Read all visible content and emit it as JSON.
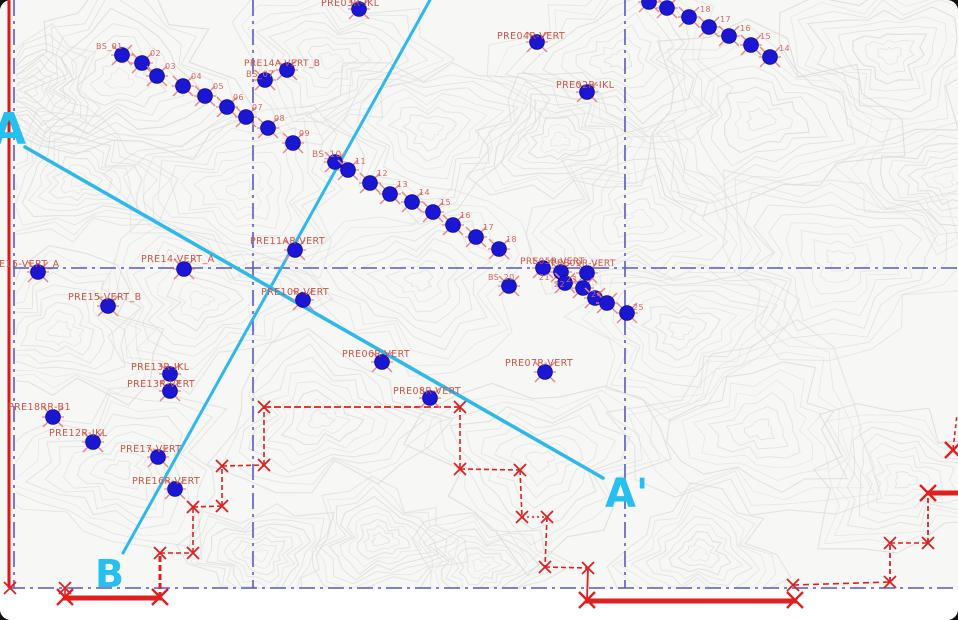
{
  "map": {
    "width": 958,
    "height": 620,
    "background": "#f7f7f6",
    "contour_color": "#dcdcdb",
    "content_bottom": 589
  },
  "colors": {
    "point_blue": "#1a16d2",
    "point_edge": "#0b0b99",
    "point_tick_red": "#ec8585",
    "label_red": "#c85648",
    "label_red_small": "#cf6a5e",
    "boundary_red": "#e02020",
    "frame_red": "#e01515",
    "grid_purple": "#5a58bf",
    "section_cyan": "#2fb9e8",
    "section_label_cyan": "#25c0f0"
  },
  "frame": {
    "left_red_line": {
      "x": 9,
      "y1": 0,
      "y2": 588
    }
  },
  "grid": {
    "vertical": [
      {
        "x": 14,
        "y1": 0,
        "y2": 588
      },
      {
        "x": 253,
        "y1": 0,
        "y2": 588
      },
      {
        "x": 625,
        "y1": 0,
        "y2": 588
      }
    ],
    "horizontal": [
      {
        "y": 268,
        "x1": 13,
        "x2": 958
      },
      {
        "y": 588,
        "x1": 9,
        "x2": 958
      }
    ]
  },
  "sections": {
    "lines": [
      {
        "name": "A-A'",
        "x1": 25,
        "y1": 147,
        "x2": 603,
        "y2": 478,
        "width": 3.6
      },
      {
        "name": "B",
        "x1": 430,
        "y1": 0,
        "x2": 123,
        "y2": 553,
        "width": 3.0
      }
    ],
    "labels": [
      {
        "text": "A",
        "x": -8,
        "y": 144,
        "fs": 44
      },
      {
        "text": "A'",
        "x": 605,
        "y": 507,
        "fs": 40
      },
      {
        "text": "B",
        "x": 95,
        "y": 587,
        "fs": 38
      }
    ]
  },
  "boundary": {
    "segments": [
      {
        "x1": 65,
        "y1": 589,
        "x2": 65,
        "y2": 597,
        "w": 1.6,
        "dash": ""
      },
      {
        "x1": 63,
        "y1": 598,
        "x2": 162,
        "y2": 598,
        "w": 5,
        "dash": ""
      },
      {
        "x1": 160,
        "y1": 598,
        "x2": 160,
        "y2": 554,
        "w": 3,
        "dash": "6 3"
      },
      {
        "x1": 160,
        "y1": 553,
        "x2": 193,
        "y2": 553,
        "w": 1.6,
        "dash": "5 3"
      },
      {
        "x1": 193,
        "y1": 553,
        "x2": 193,
        "y2": 507,
        "w": 1.6,
        "dash": "5 3"
      },
      {
        "x1": 193,
        "y1": 507,
        "x2": 222,
        "y2": 506,
        "w": 1.6,
        "dash": "5 3"
      },
      {
        "x1": 222,
        "y1": 506,
        "x2": 222,
        "y2": 466,
        "w": 1.6,
        "dash": "5 3"
      },
      {
        "x1": 222,
        "y1": 466,
        "x2": 264,
        "y2": 465,
        "w": 1.6,
        "dash": "5 3"
      },
      {
        "x1": 264,
        "y1": 465,
        "x2": 264,
        "y2": 407,
        "w": 1.6,
        "dash": "5 3"
      },
      {
        "x1": 264,
        "y1": 407,
        "x2": 460,
        "y2": 407,
        "w": 1.7,
        "dash": "7 3"
      },
      {
        "x1": 460,
        "y1": 407,
        "x2": 460,
        "y2": 469,
        "w": 1.6,
        "dash": "5 3"
      },
      {
        "x1": 460,
        "y1": 469,
        "x2": 520,
        "y2": 470,
        "w": 1.6,
        "dash": "5 3"
      },
      {
        "x1": 520,
        "y1": 470,
        "x2": 522,
        "y2": 517,
        "w": 1.6,
        "dash": "5 3"
      },
      {
        "x1": 522,
        "y1": 517,
        "x2": 547,
        "y2": 517,
        "w": 1.6,
        "dash": "2 3"
      },
      {
        "x1": 547,
        "y1": 517,
        "x2": 545,
        "y2": 567,
        "w": 1.6,
        "dash": "5 3"
      },
      {
        "x1": 545,
        "y1": 567,
        "x2": 588,
        "y2": 568,
        "w": 1.6,
        "dash": "5 3"
      },
      {
        "x1": 588,
        "y1": 568,
        "x2": 587,
        "y2": 600,
        "w": 1.8,
        "dash": ""
      },
      {
        "x1": 585,
        "y1": 601,
        "x2": 797,
        "y2": 601,
        "w": 5,
        "dash": ""
      },
      {
        "x1": 793,
        "y1": 585,
        "x2": 890,
        "y2": 582,
        "w": 1.6,
        "dash": "6 4"
      },
      {
        "x1": 890,
        "y1": 582,
        "x2": 890,
        "y2": 543,
        "w": 1.8,
        "dash": "5 3"
      },
      {
        "x1": 890,
        "y1": 543,
        "x2": 928,
        "y2": 543,
        "w": 1.6,
        "dash": "5 3"
      },
      {
        "x1": 928,
        "y1": 543,
        "x2": 928,
        "y2": 493,
        "w": 1.8,
        "dash": "5 3"
      },
      {
        "x1": 926,
        "y1": 493,
        "x2": 958,
        "y2": 493,
        "w": 5,
        "dash": ""
      },
      {
        "x1": 953,
        "y1": 449,
        "x2": 957,
        "y2": 415,
        "w": 1.6,
        "dash": "4 3"
      }
    ],
    "x_marks": [
      {
        "x": 10,
        "y": 588,
        "big": false
      },
      {
        "x": 65,
        "y": 588,
        "big": false
      },
      {
        "x": 65,
        "y": 597,
        "big": true
      },
      {
        "x": 160,
        "y": 597,
        "big": true
      },
      {
        "x": 160,
        "y": 553,
        "big": false
      },
      {
        "x": 193,
        "y": 553,
        "big": false
      },
      {
        "x": 193,
        "y": 507,
        "big": false
      },
      {
        "x": 222,
        "y": 506,
        "big": false
      },
      {
        "x": 222,
        "y": 466,
        "big": false
      },
      {
        "x": 264,
        "y": 465,
        "big": false
      },
      {
        "x": 264,
        "y": 407,
        "big": false
      },
      {
        "x": 460,
        "y": 407,
        "big": false
      },
      {
        "x": 460,
        "y": 469,
        "big": false
      },
      {
        "x": 520,
        "y": 470,
        "big": false
      },
      {
        "x": 522,
        "y": 517,
        "big": false
      },
      {
        "x": 547,
        "y": 517,
        "big": false
      },
      {
        "x": 545,
        "y": 567,
        "big": false
      },
      {
        "x": 588,
        "y": 568,
        "big": false
      },
      {
        "x": 587,
        "y": 600,
        "big": true
      },
      {
        "x": 795,
        "y": 600,
        "big": true
      },
      {
        "x": 793,
        "y": 585,
        "big": false
      },
      {
        "x": 890,
        "y": 582,
        "big": false
      },
      {
        "x": 890,
        "y": 543,
        "big": false
      },
      {
        "x": 928,
        "y": 543,
        "big": false
      },
      {
        "x": 928,
        "y": 493,
        "big": true
      },
      {
        "x": 953,
        "y": 450,
        "big": true
      }
    ]
  },
  "survey_points": {
    "points": [
      {
        "x": 122,
        "y": 55,
        "label": "BS_01",
        "lx": 96,
        "ly": 49,
        "fs": 8
      },
      {
        "x": 142,
        "y": 63,
        "label": "02",
        "lx": 150,
        "ly": 56,
        "fs": 8
      },
      {
        "x": 157,
        "y": 76,
        "label": "03",
        "lx": 165,
        "ly": 69,
        "fs": 8
      },
      {
        "x": 183,
        "y": 86,
        "label": "04",
        "lx": 191,
        "ly": 79,
        "fs": 8
      },
      {
        "x": 205,
        "y": 96,
        "label": "05",
        "lx": 213,
        "ly": 89,
        "fs": 8
      },
      {
        "x": 227,
        "y": 107,
        "label": "06",
        "lx": 233,
        "ly": 100,
        "fs": 8
      },
      {
        "x": 246,
        "y": 117,
        "label": "07",
        "lx": 252,
        "ly": 110,
        "fs": 8
      },
      {
        "x": 268,
        "y": 128,
        "label": "08",
        "lx": 274,
        "ly": 121,
        "fs": 8
      },
      {
        "x": 293,
        "y": 143,
        "label": "09",
        "lx": 299,
        "ly": 136,
        "fs": 8
      },
      {
        "x": 265,
        "y": 80,
        "label": "",
        "lx": 0,
        "ly": 0,
        "fs": 8
      },
      {
        "x": 287,
        "y": 70,
        "label": "",
        "lx": 0,
        "ly": 0,
        "fs": 8
      },
      {
        "x": 335,
        "y": 162,
        "label": "BS_10",
        "lx": 312,
        "ly": 157,
        "fs": 9
      },
      {
        "x": 348,
        "y": 170,
        "label": "11",
        "lx": 355,
        "ly": 164,
        "fs": 8
      },
      {
        "x": 370,
        "y": 183,
        "label": "12",
        "lx": 377,
        "ly": 176,
        "fs": 8
      },
      {
        "x": 390,
        "y": 194,
        "label": "13",
        "lx": 397,
        "ly": 187,
        "fs": 8
      },
      {
        "x": 412,
        "y": 202,
        "label": "14",
        "lx": 419,
        "ly": 195,
        "fs": 8
      },
      {
        "x": 433,
        "y": 212,
        "label": "15",
        "lx": 440,
        "ly": 205,
        "fs": 8
      },
      {
        "x": 453,
        "y": 225,
        "label": "16",
        "lx": 460,
        "ly": 218,
        "fs": 8
      },
      {
        "x": 476,
        "y": 237,
        "label": "17",
        "lx": 483,
        "ly": 230,
        "fs": 8
      },
      {
        "x": 499,
        "y": 249,
        "label": "18",
        "lx": 506,
        "ly": 242,
        "fs": 8
      },
      {
        "x": 543,
        "y": 268,
        "label": "",
        "lx": 0,
        "ly": 0,
        "fs": 8
      },
      {
        "x": 561,
        "y": 272,
        "label": "",
        "lx": 0,
        "ly": 0,
        "fs": 8
      },
      {
        "x": 587,
        "y": 273,
        "label": "",
        "lx": 0,
        "ly": 0,
        "fs": 8
      },
      {
        "x": 565,
        "y": 283,
        "label": "",
        "lx": 0,
        "ly": 0,
        "fs": 8
      },
      {
        "x": 583,
        "y": 288,
        "label": "",
        "lx": 0,
        "ly": 0,
        "fs": 8
      },
      {
        "x": 509,
        "y": 286,
        "label": "BS_20",
        "lx": 488,
        "ly": 280,
        "fs": 8
      },
      {
        "x": 595,
        "y": 298,
        "label": "",
        "lx": 0,
        "ly": 0,
        "fs": 8
      },
      {
        "x": 607,
        "y": 303,
        "label": "",
        "lx": 0,
        "ly": 0,
        "fs": 8
      },
      {
        "x": 627,
        "y": 313,
        "label": "",
        "lx": 0,
        "ly": 0,
        "fs": 8
      },
      {
        "x": 649,
        "y": 2,
        "label": "",
        "lx": 0,
        "ly": 0,
        "fs": 8
      },
      {
        "x": 667,
        "y": 8,
        "label": "",
        "lx": 0,
        "ly": 0,
        "fs": 8
      },
      {
        "x": 689,
        "y": 17,
        "label": "18",
        "lx": 700,
        "ly": 12,
        "fs": 8
      },
      {
        "x": 709,
        "y": 27,
        "label": "17",
        "lx": 720,
        "ly": 22,
        "fs": 8
      },
      {
        "x": 729,
        "y": 36,
        "label": "16",
        "lx": 740,
        "ly": 31,
        "fs": 8
      },
      {
        "x": 751,
        "y": 45,
        "label": "15",
        "lx": 760,
        "ly": 39,
        "fs": 8
      },
      {
        "x": 770,
        "y": 57,
        "label": "14",
        "lx": 779,
        "ly": 51,
        "fs": 8
      },
      {
        "x": 359,
        "y": 9,
        "label": "PRE03R-IKL",
        "lx": 321,
        "ly": 6,
        "fs": 9.5
      },
      {
        "x": 537,
        "y": 42,
        "label": "PRE04R-VERT",
        "lx": 497,
        "ly": 39,
        "fs": 9.5
      },
      {
        "x": 587,
        "y": 92,
        "label": "PRE02R-IKL",
        "lx": 556,
        "ly": 88,
        "fs": 9.5
      },
      {
        "x": 38,
        "y": 272,
        "label": "PRE15-VERT_A",
        "lx": -14,
        "ly": 267,
        "fs": 9.5
      },
      {
        "x": 184,
        "y": 269,
        "label": "PRE14-VERT_A",
        "lx": 141,
        "ly": 262,
        "fs": 9.5
      },
      {
        "x": 108,
        "y": 306,
        "label": "PRE15-VERT_B",
        "lx": 68,
        "ly": 300,
        "fs": 9.5
      },
      {
        "x": 295,
        "y": 250,
        "label": "PRE11AR-VERT",
        "lx": 250,
        "ly": 244,
        "fs": 9.5
      },
      {
        "x": 303,
        "y": 300,
        "label": "PRE10R-VERT",
        "lx": 261,
        "ly": 295,
        "fs": 9.5
      },
      {
        "x": 170,
        "y": 374,
        "label": "PRE13R-IKL",
        "lx": 131,
        "ly": 370,
        "fs": 9.5
      },
      {
        "x": 170,
        "y": 391,
        "label": "PRE13R-VERT",
        "lx": 127,
        "ly": 387,
        "fs": 9.5
      },
      {
        "x": 53,
        "y": 417,
        "label": "PRE18RR-B1",
        "lx": 8,
        "ly": 410,
        "fs": 9.5
      },
      {
        "x": 93,
        "y": 442,
        "label": "PRE12R-IKL",
        "lx": 49,
        "ly": 436,
        "fs": 9.5
      },
      {
        "x": 158,
        "y": 457,
        "label": "PRE17-VERT",
        "lx": 120,
        "ly": 452,
        "fs": 9.5
      },
      {
        "x": 175,
        "y": 489,
        "label": "PRE16R-VERT",
        "lx": 132,
        "ly": 484,
        "fs": 9.5
      },
      {
        "x": 382,
        "y": 362,
        "label": "PRE06R-VERT",
        "lx": 342,
        "ly": 357,
        "fs": 9.5
      },
      {
        "x": 545,
        "y": 372,
        "label": "PRE07R-VERT",
        "lx": 505,
        "ly": 366,
        "fs": 9.5
      },
      {
        "x": 430,
        "y": 398,
        "label": "PRE08R-VERT",
        "lx": 393,
        "ly": 394,
        "fs": 9.5
      }
    ],
    "extra_labels": [
      {
        "text": "PRE14A-VERT_B",
        "x": 244,
        "y": 66,
        "fs": 9
      },
      {
        "text": "BS_07",
        "x": 246,
        "y": 77,
        "fs": 8.5
      },
      {
        "text": "PRE05R-VERT",
        "x": 520,
        "y": 264,
        "fs": 9
      },
      {
        "text": "PRE09R-VERT",
        "x": 551,
        "y": 266,
        "fs": 9
      },
      {
        "text": "21",
        "x": 539,
        "y": 280,
        "fs": 8
      },
      {
        "text": "22",
        "x": 554,
        "y": 287,
        "fs": 8
      },
      {
        "text": "23",
        "x": 566,
        "y": 282,
        "fs": 8
      },
      {
        "text": "24",
        "x": 591,
        "y": 297,
        "fs": 8
      },
      {
        "text": "25",
        "x": 633,
        "y": 310,
        "fs": 8
      }
    ]
  }
}
